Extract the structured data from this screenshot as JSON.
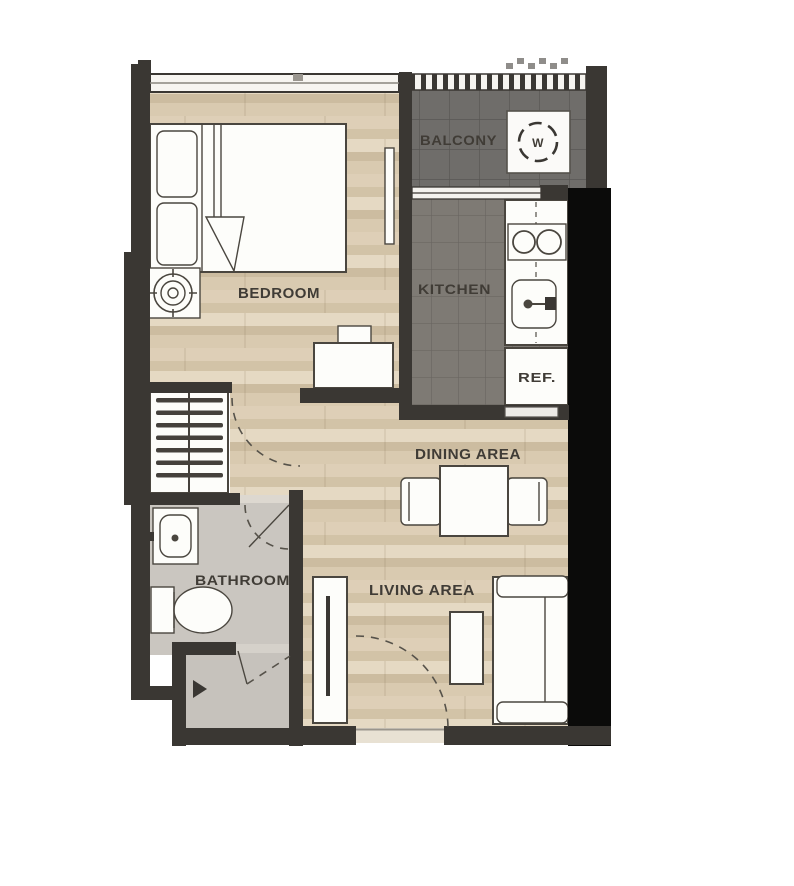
{
  "floorplan": {
    "type": "apartment-unit-floor-plan",
    "rooms": {
      "bedroom": {
        "label": "BEDROOM"
      },
      "balcony": {
        "label": "BALCONY"
      },
      "kitchen": {
        "label": "KITCHEN"
      },
      "dining": {
        "label": "DINING AREA"
      },
      "living": {
        "label": "LIVING AREA"
      },
      "bathroom": {
        "label": "BATHROOM"
      }
    },
    "appliances": {
      "refrigerator": {
        "label": "REF."
      },
      "washer": {
        "label": "W"
      }
    },
    "icons": {
      "washer": "washer-drum-icon",
      "bedside_lamp": "target-circles-icon",
      "stove": "two-burner-icon",
      "kitchen_sink": "basin-faucet-icon",
      "bathroom_sink": "basin-icon",
      "toilet": "toilet-icon",
      "wardrobe": "hanger-rail-icon"
    },
    "colors": {
      "wall": "#3a3733",
      "structural_black": "#0b0b0a",
      "wood_floor_light": "#e4d8c2",
      "wood_floor_dark": "#d0c1a5",
      "balcony_floor": "#6f6d6a",
      "kitchen_floor": "#7e7a74",
      "bathroom_floor": "#cac6c0",
      "furniture_fill": "#fdfdfa",
      "furniture_outline": "#4a463f",
      "label_text": "#403c36"
    }
  }
}
